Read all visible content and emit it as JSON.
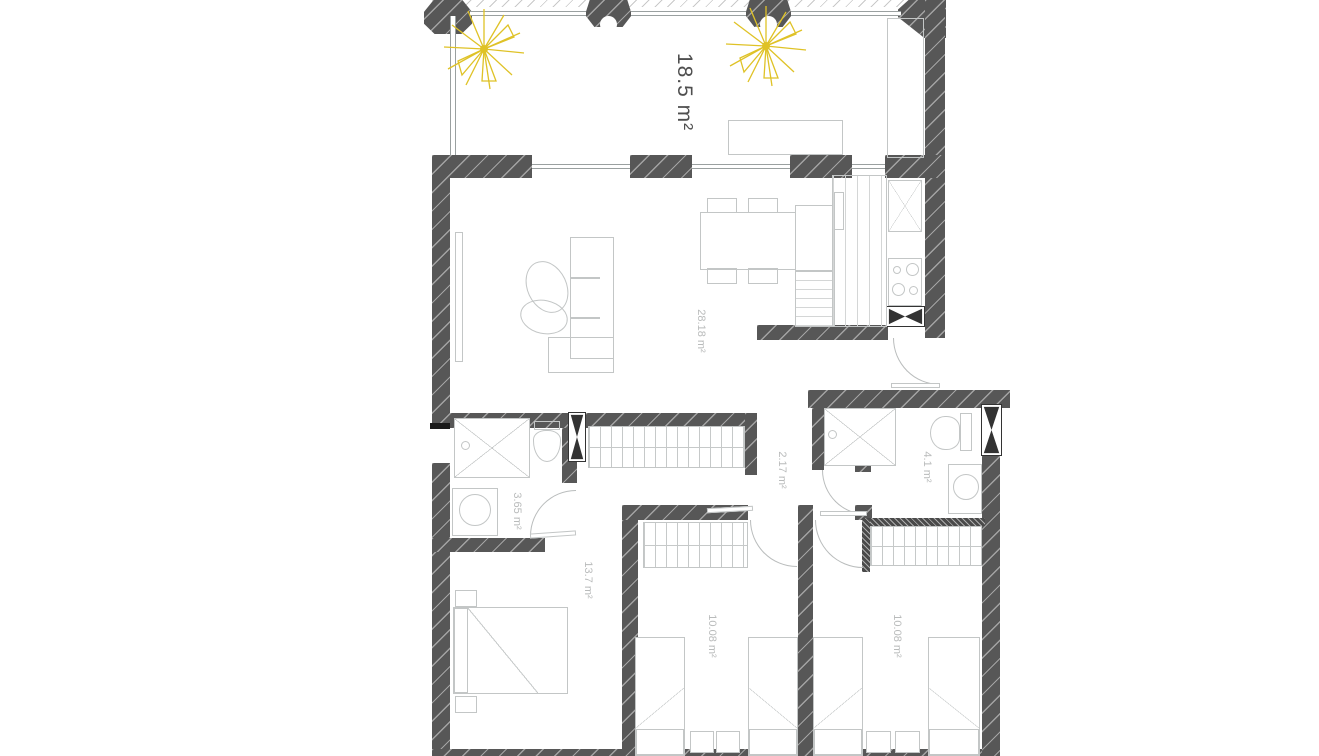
{
  "plan": {
    "type": "apartment-floor-plan",
    "unit": "m²",
    "rooms": [
      {
        "name": "terrace",
        "area_label": "18.5 m²"
      },
      {
        "name": "living-dining-kitchen",
        "area_label": "28.18 m²"
      },
      {
        "name": "bathroom-1",
        "area_label": "3.65 m²"
      },
      {
        "name": "hallway",
        "area_label": "2.17 m²"
      },
      {
        "name": "bathroom-2",
        "area_label": "4.1 m²"
      },
      {
        "name": "bedroom-1",
        "area_label": "13.7 m²"
      },
      {
        "name": "bedroom-2",
        "area_label": "10.08 m²"
      },
      {
        "name": "bedroom-3",
        "area_label": "10.08 m²"
      }
    ],
    "colors": {
      "wall": "#575757",
      "furniture_line": "#c3c6c6",
      "label_light": "#b9bbbb",
      "label_dark": "#4f4f4f",
      "palm_yellow": "#dfc226"
    }
  }
}
